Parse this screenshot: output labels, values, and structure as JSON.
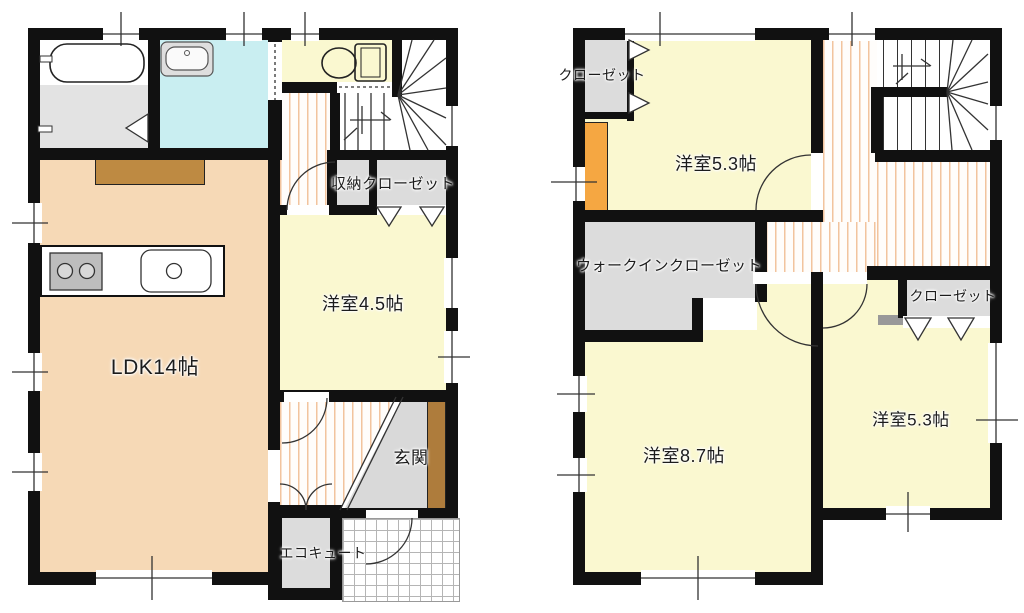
{
  "floorplans": {
    "first_floor": {
      "ldk_label": "LDK14帖",
      "western_room_label": "洋室4.5帖",
      "storage_closet_label": "収納クローゼット",
      "entrance_label": "玄関",
      "ecocute_label": "エコキュート"
    },
    "second_floor": {
      "closet_topleft_label": "クローゼット",
      "western_room_53_top_label": "洋室5.3帖",
      "walkin_closet_label": "ウォークインクローゼット",
      "western_room_87_label": "洋室8.7帖",
      "western_room_53_right_label": "洋室5.3帖",
      "closet_right_label": "クローゼット"
    }
  },
  "colors": {
    "wall": "#111111",
    "ldk_floor": "#f6d9b6",
    "room_floor": "#faf8d0",
    "washroom_floor": "#c9eef1",
    "closet_floor": "#dcdcdc",
    "entrance_floor": "#d9d9d9",
    "shoe_cabinet_wood": "#ae7c3c",
    "counter_wood": "#be8a42",
    "accent_orange": "#f5a742",
    "floor_stripe": "#f2c49e"
  },
  "fixtures": [
    "bathtub-icon",
    "washbasin-icon",
    "toilet-icon",
    "stove-icon",
    "kitchen-sink-icon",
    "staircase-icon"
  ]
}
